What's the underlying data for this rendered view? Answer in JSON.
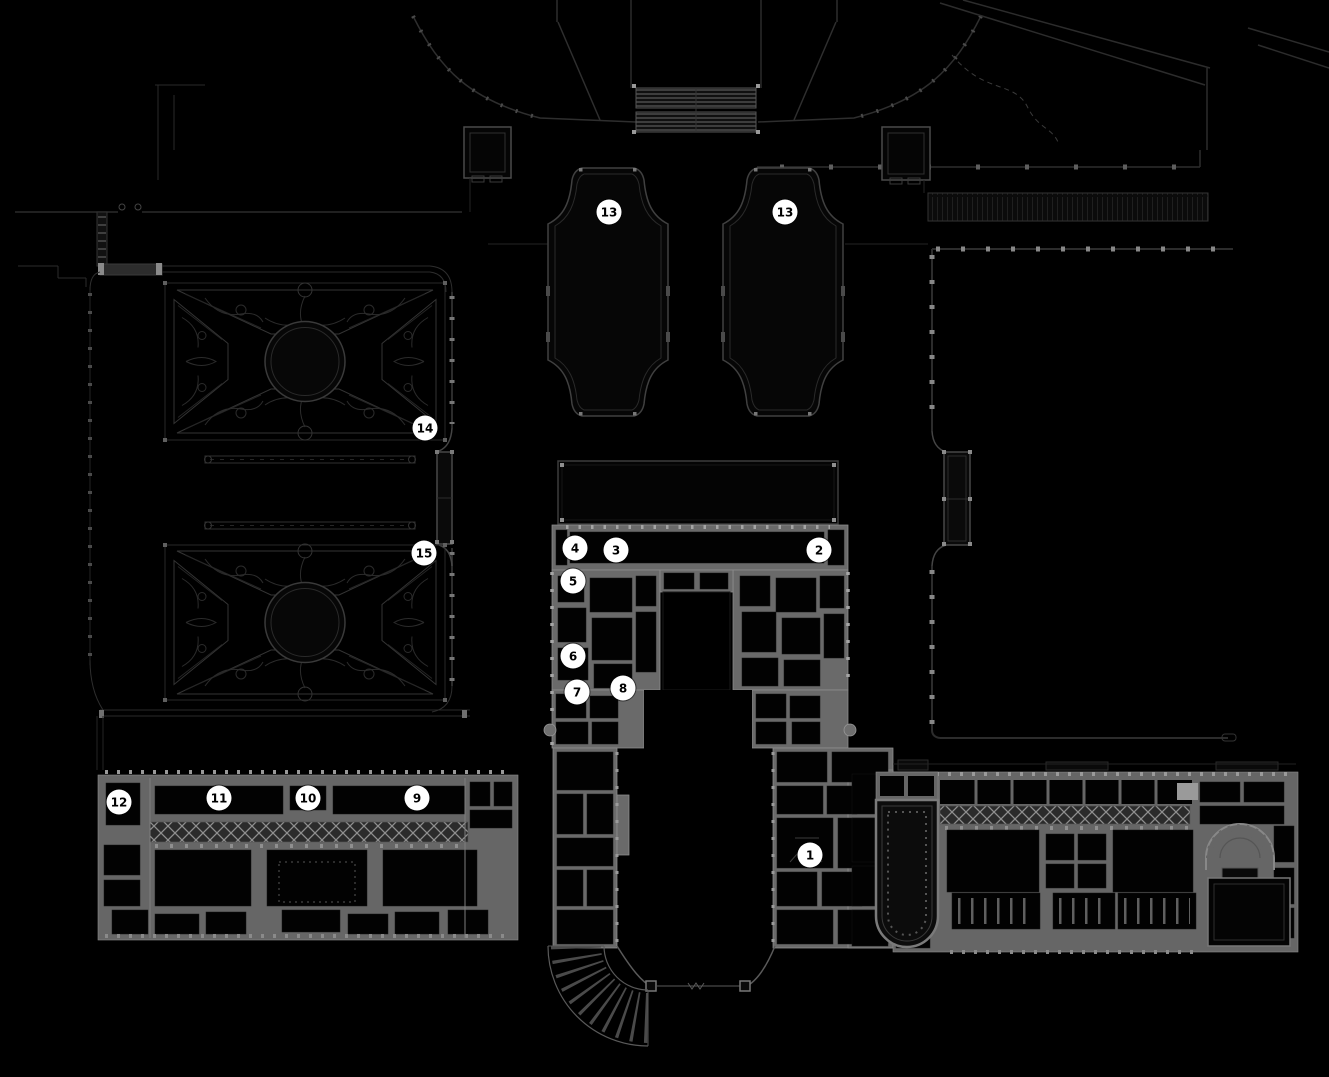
{
  "map": {
    "background_color": "#000000",
    "marker_style": {
      "fill": "#ffffff",
      "text_color": "#000000",
      "diameter_px": 25
    },
    "markers": [
      {
        "label": "1",
        "x": 810,
        "y": 855
      },
      {
        "label": "2",
        "x": 819,
        "y": 550
      },
      {
        "label": "3",
        "x": 616,
        "y": 550
      },
      {
        "label": "4",
        "x": 575,
        "y": 548
      },
      {
        "label": "5",
        "x": 573,
        "y": 581
      },
      {
        "label": "6",
        "x": 573,
        "y": 656
      },
      {
        "label": "7",
        "x": 577,
        "y": 692
      },
      {
        "label": "8",
        "x": 623,
        "y": 688
      },
      {
        "label": "9",
        "x": 417,
        "y": 798
      },
      {
        "label": "10",
        "x": 308,
        "y": 798
      },
      {
        "label": "11",
        "x": 219,
        "y": 798
      },
      {
        "label": "12",
        "x": 119,
        "y": 802
      },
      {
        "label": "13",
        "x": 609,
        "y": 212
      },
      {
        "label": "13",
        "x": 785,
        "y": 212
      },
      {
        "label": "14",
        "x": 425,
        "y": 428
      },
      {
        "label": "15",
        "x": 424,
        "y": 553
      }
    ]
  }
}
